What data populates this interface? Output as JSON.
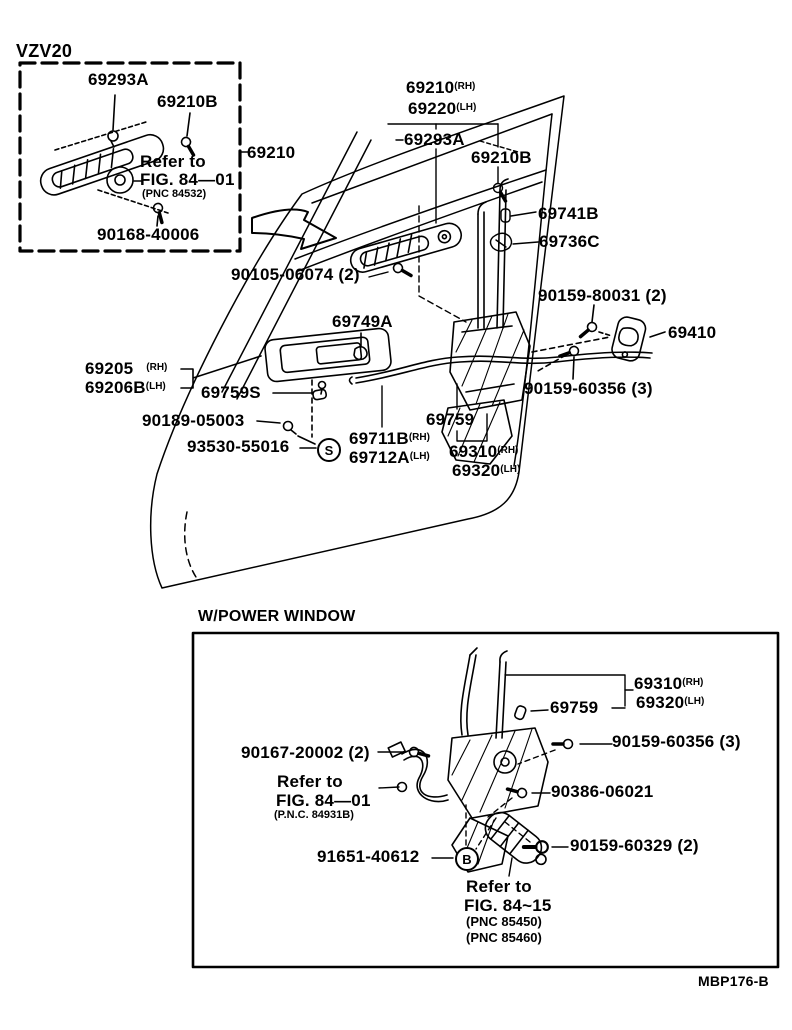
{
  "colors": {
    "ink": "#000000",
    "paper": "#ffffff"
  },
  "inset": {
    "variant": "VZV20",
    "labels": {
      "p69293a": {
        "text": "69293A"
      },
      "p69210b": {
        "text": "69210B"
      },
      "refer_line1": "Refer to",
      "refer_line2": "FIG. 84—01",
      "refer_line3": "(PNC 84532)",
      "p90168": {
        "text": "90168-40006"
      },
      "p69210": {
        "text": "69210"
      }
    }
  },
  "main": {
    "labels": {
      "p69210": {
        "text": "69210",
        "suffix": "(RH)"
      },
      "p69220": {
        "text": "69220",
        "suffix": "(LH)"
      },
      "p69293a": {
        "text": "69293A"
      },
      "p69210b": {
        "text": "69210B"
      },
      "p69741b": {
        "text": "69741B"
      },
      "p69736c": {
        "text": "69736C"
      },
      "p90105": {
        "text": "90105-06074 (2)"
      },
      "p90159_80031": {
        "text": "90159-80031 (2)"
      },
      "p69410": {
        "text": "69410"
      },
      "p69749a": {
        "text": "69749A"
      },
      "p90159_60356": {
        "text": "90159-60356 (3)"
      },
      "p69205": {
        "text": "69205",
        "suffix": "(RH)"
      },
      "p69206b": {
        "text": "69206B",
        "suffix": "(LH)"
      },
      "p69759s": {
        "text": "69759S"
      },
      "p90189": {
        "text": "90189-05003"
      },
      "p93530": {
        "text": "93530-55016"
      },
      "marker_s": {
        "text": "S"
      },
      "p69711b": {
        "text": "69711B",
        "suffix": "(RH)"
      },
      "p69712a": {
        "text": "69712A",
        "suffix": "(LH)"
      },
      "p69759": {
        "text": "69759"
      },
      "p69310": {
        "text": "69310",
        "suffix": "(RH)"
      },
      "p69320": {
        "text": "69320",
        "suffix": "(LH)"
      }
    }
  },
  "power_window": {
    "title": "W/POWER WINDOW",
    "labels": {
      "p69310": {
        "text": "69310",
        "suffix": "(RH)"
      },
      "p69320": {
        "text": "69320",
        "suffix": "(LH)"
      },
      "p69759": {
        "text": "69759"
      },
      "p90167": {
        "text": "90167-20002 (2)"
      },
      "p90159_60356": {
        "text": "90159-60356 (3)"
      },
      "refer_8401_line1": "Refer to",
      "refer_8401_line2": "FIG. 84—01",
      "refer_8401_line3": "(P.N.C. 84931B)",
      "p90386": {
        "text": "90386-06021"
      },
      "p91651": {
        "text": "91651-40612"
      },
      "marker_b": {
        "text": "B"
      },
      "p90159_60329": {
        "text": "90159-60329 (2)"
      },
      "refer_8415_line1": "Refer to",
      "refer_8415_line2": "FIG. 84~15",
      "refer_8415_line3": "(PNC 85450)",
      "refer_8415_line4": "(PNC 85460)"
    }
  },
  "footer": {
    "drawing_code": "MBP176-B"
  }
}
